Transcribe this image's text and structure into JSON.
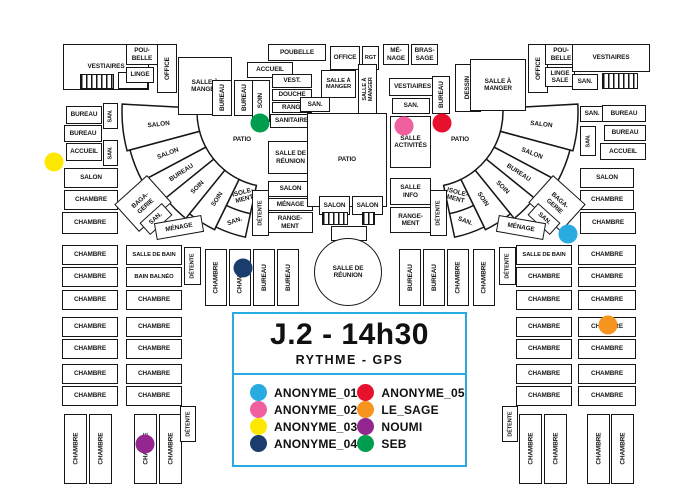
{
  "legend": {
    "title": "J.2 - 14h30",
    "subtitle": "RYTHME - GPS",
    "border_color": "#29ABE2",
    "entries": [
      {
        "name": "ANONYME_01",
        "color": "#29ABE2"
      },
      {
        "name": "ANONYME_02",
        "color": "#F0609F"
      },
      {
        "name": "ANONYME_03",
        "color": "#FFE800"
      },
      {
        "name": "ANONYME_04",
        "color": "#1B3D6D"
      },
      {
        "name": "ANONYME_05",
        "color": "#E8112D"
      },
      {
        "name": "LE_SAGE",
        "color": "#F7941D"
      },
      {
        "name": "NOUMI",
        "color": "#93278F"
      },
      {
        "name": "SEB",
        "color": "#009D4E"
      }
    ]
  },
  "floorplan": {
    "wall_color": "#161616",
    "positions": [
      {
        "name": "ANONYME_01",
        "x": 568,
        "y": 234
      },
      {
        "name": "ANONYME_02",
        "x": 404,
        "y": 126
      },
      {
        "name": "ANONYME_03",
        "x": 54,
        "y": 162
      },
      {
        "name": "ANONYME_04",
        "x": 243,
        "y": 268
      },
      {
        "name": "ANONYME_05",
        "x": 442,
        "y": 123
      },
      {
        "name": "LE_SAGE",
        "x": 608,
        "y": 325
      },
      {
        "name": "NOUMI",
        "x": 145,
        "y": 444
      },
      {
        "name": "SEB",
        "x": 260,
        "y": 123
      }
    ],
    "rooms": [
      {
        "l": "VESTIAIRES",
        "x": 63,
        "y": 44,
        "w": 86,
        "h": 46
      },
      {
        "l": "SAN.",
        "x": 118,
        "y": 72,
        "w": 30,
        "h": 17
      },
      {
        "l": "POU-\nBELLE",
        "x": 126,
        "y": 44,
        "w": 32,
        "h": 21
      },
      {
        "l": "LINGE",
        "x": 126,
        "y": 67,
        "w": 28,
        "h": 16
      },
      {
        "l": "OFFICE",
        "x": 157,
        "y": 44,
        "w": 20,
        "h": 49,
        "v": 1
      },
      {
        "l": "SALLE À\nMANGER",
        "x": 178,
        "y": 57,
        "w": 54,
        "h": 58
      },
      {
        "l": "BUREAU",
        "x": 212,
        "y": 80,
        "w": 20,
        "h": 36,
        "v": 1
      },
      {
        "l": "BUREAU",
        "x": 234,
        "y": 80,
        "w": 20,
        "h": 36,
        "v": 1
      },
      {
        "l": "BUREAU",
        "x": 66,
        "y": 106,
        "w": 36,
        "h": 18
      },
      {
        "l": "SAN.",
        "x": 103,
        "y": 103,
        "w": 15,
        "h": 26,
        "v": 1,
        "fs": 5.5
      },
      {
        "l": "BUREAU",
        "x": 64,
        "y": 125,
        "w": 38,
        "h": 17
      },
      {
        "l": "ACCUEIL",
        "x": 66,
        "y": 143,
        "w": 36,
        "h": 18
      },
      {
        "l": "SAN.",
        "x": 103,
        "y": 140,
        "w": 15,
        "h": 26,
        "v": 1,
        "fs": 5.5
      },
      {
        "l": "SALON",
        "x": 64,
        "y": 168,
        "w": 54,
        "h": 20
      },
      {
        "l": "CHAMBRE",
        "x": 64,
        "y": 190,
        "w": 54,
        "h": 20
      },
      {
        "l": "CHAMBRE",
        "x": 62,
        "y": 212,
        "w": 56,
        "h": 22
      },
      {
        "l": "ACCUEIL",
        "x": 247,
        "y": 62,
        "w": 46,
        "h": 16
      },
      {
        "l": "SOIN",
        "x": 252,
        "y": 80,
        "w": 18,
        "h": 42,
        "v": 1
      },
      {
        "l": "VEST.",
        "x": 272,
        "y": 74,
        "w": 40,
        "h": 14
      },
      {
        "l": "DOUCHE",
        "x": 272,
        "y": 89,
        "w": 40,
        "h": 12
      },
      {
        "l": "RANG.",
        "x": 272,
        "y": 102,
        "w": 40,
        "h": 11
      },
      {
        "l": "SANITAIRE",
        "x": 270,
        "y": 114,
        "w": 43,
        "h": 14
      },
      {
        "l": "SALLE DE\nRÉUNION",
        "x": 268,
        "y": 141,
        "w": 45,
        "h": 33
      },
      {
        "l": "SALON",
        "x": 268,
        "y": 181,
        "w": 45,
        "h": 16
      },
      {
        "l": "MÉNAGE",
        "x": 268,
        "y": 198,
        "w": 45,
        "h": 13
      },
      {
        "l": "RANGE-\nMENT",
        "x": 267,
        "y": 212,
        "w": 46,
        "h": 21
      },
      {
        "l": "POUBELLE",
        "x": 268,
        "y": 44,
        "w": 58,
        "h": 17
      },
      {
        "l": "OFFICE",
        "x": 330,
        "y": 46,
        "w": 30,
        "h": 24
      },
      {
        "l": "RGT",
        "x": 362,
        "y": 46,
        "w": 17,
        "h": 24,
        "fs": 5.5
      },
      {
        "l": "MÉ-\nNAGE",
        "x": 383,
        "y": 44,
        "w": 26,
        "h": 21
      },
      {
        "l": "BRAS-\nSAGE",
        "x": 411,
        "y": 44,
        "w": 27,
        "h": 21
      },
      {
        "l": "SALLE À\nMANGER",
        "x": 321,
        "y": 70,
        "w": 35,
        "h": 28,
        "fs": 5.8
      },
      {
        "l": "SALLE À\nMANGER",
        "x": 358,
        "y": 64,
        "w": 19,
        "h": 50,
        "v": 1,
        "fs": 5.5
      },
      {
        "l": "SAN.",
        "x": 300,
        "y": 97,
        "w": 30,
        "h": 15
      },
      {
        "l": "PATIO",
        "x": 307,
        "y": 113,
        "w": 80,
        "h": 94
      },
      {
        "l": "SALON",
        "x": 319,
        "y": 196,
        "w": 31,
        "h": 19
      },
      {
        "l": "SALON",
        "x": 352,
        "y": 196,
        "w": 31,
        "h": 19
      },
      {
        "l": "",
        "x": 331,
        "y": 226,
        "w": 36,
        "h": 15
      },
      {
        "l": "VESTIAIRES",
        "x": 389,
        "y": 78,
        "w": 47,
        "h": 18
      },
      {
        "l": "SAN.",
        "x": 392,
        "y": 98,
        "w": 38,
        "h": 16
      },
      {
        "l": "SALLE\nACTIVITÉS",
        "x": 390,
        "y": 116,
        "w": 41,
        "h": 52
      },
      {
        "l": "SALLE\nINFO",
        "x": 390,
        "y": 178,
        "w": 41,
        "h": 27
      },
      {
        "l": "RANGE-\nMENT",
        "x": 390,
        "y": 207,
        "w": 41,
        "h": 26
      },
      {
        "l": "BUREAU",
        "x": 432,
        "y": 76,
        "w": 18,
        "h": 38,
        "v": 1
      },
      {
        "l": "DESSIN",
        "x": 455,
        "y": 64,
        "w": 26,
        "h": 48,
        "v": 1
      },
      {
        "l": "PATIO",
        "x": 222,
        "y": 132,
        "w": 40,
        "h": 16,
        "nb": 1
      },
      {
        "l": "PATIO",
        "x": 440,
        "y": 132,
        "w": 40,
        "h": 16,
        "nb": 1
      },
      {
        "l": "SALLE À\nMANGER",
        "x": 470,
        "y": 59,
        "w": 56,
        "h": 52
      },
      {
        "l": "OFFICE",
        "x": 528,
        "y": 44,
        "w": 20,
        "h": 49,
        "v": 1
      },
      {
        "l": "POU-\nBELLE",
        "x": 545,
        "y": 44,
        "w": 32,
        "h": 21
      },
      {
        "l": "LINGE\nSALE",
        "x": 545,
        "y": 67,
        "w": 30,
        "h": 20
      },
      {
        "l": "VESTIAIRES",
        "x": 572,
        "y": 44,
        "w": 78,
        "h": 28
      },
      {
        "l": "SAN.",
        "x": 572,
        "y": 74,
        "w": 26,
        "h": 16
      },
      {
        "l": "SAN.",
        "x": 580,
        "y": 106,
        "w": 24,
        "h": 16
      },
      {
        "l": "BUREAU",
        "x": 602,
        "y": 105,
        "w": 44,
        "h": 17
      },
      {
        "l": "SAN.",
        "x": 580,
        "y": 126,
        "w": 16,
        "h": 30,
        "v": 1,
        "fs": 5.5
      },
      {
        "l": "BUREAU",
        "x": 604,
        "y": 125,
        "w": 42,
        "h": 16
      },
      {
        "l": "ACCUEIL",
        "x": 600,
        "y": 143,
        "w": 46,
        "h": 17
      },
      {
        "l": "SALON",
        "x": 580,
        "y": 168,
        "w": 54,
        "h": 20
      },
      {
        "l": "CHAMBRE",
        "x": 580,
        "y": 190,
        "w": 54,
        "h": 20
      },
      {
        "l": "CHAMBRE",
        "x": 580,
        "y": 212,
        "w": 56,
        "h": 22
      },
      {
        "l": "BAGA-\nGERIE",
        "x": 121,
        "y": 185,
        "w": 44,
        "h": 37,
        "rot": -42
      },
      {
        "l": "SAN.",
        "x": 141,
        "y": 211,
        "w": 30,
        "h": 16,
        "rot": -42
      },
      {
        "l": "MÉNAGE",
        "x": 155,
        "y": 219,
        "w": 48,
        "h": 17,
        "rot": -10
      },
      {
        "l": "BAGA-\nGERIE",
        "x": 535,
        "y": 185,
        "w": 44,
        "h": 37,
        "rot": 42
      },
      {
        "l": "SAN.",
        "x": 529,
        "y": 211,
        "w": 30,
        "h": 16,
        "rot": 42
      },
      {
        "l": "MÉNAGE",
        "x": 497,
        "y": 219,
        "w": 48,
        "h": 17,
        "rot": 10
      },
      {
        "l": "DÉTENTE",
        "x": 252,
        "y": 190,
        "w": 17,
        "h": 46,
        "v": 1,
        "fs": 5.5
      },
      {
        "l": "DÉTENTE",
        "x": 430,
        "y": 190,
        "w": 17,
        "h": 46,
        "v": 1,
        "fs": 5.5
      },
      {
        "l": "DÉTENTE",
        "x": 184,
        "y": 247,
        "w": 17,
        "h": 38,
        "v": 1,
        "fs": 5.5
      },
      {
        "l": "CHAMBRE",
        "x": 205,
        "y": 249,
        "w": 22,
        "h": 57,
        "v": 1
      },
      {
        "l": "CHAMBRE",
        "x": 229,
        "y": 249,
        "w": 22,
        "h": 57,
        "v": 1
      },
      {
        "l": "BUREAU",
        "x": 253,
        "y": 249,
        "w": 22,
        "h": 57,
        "v": 1
      },
      {
        "l": "BUREAU",
        "x": 277,
        "y": 249,
        "w": 22,
        "h": 57,
        "v": 1
      },
      {
        "l": "BUREAU",
        "x": 399,
        "y": 249,
        "w": 22,
        "h": 57,
        "v": 1
      },
      {
        "l": "BUREAU",
        "x": 423,
        "y": 249,
        "w": 22,
        "h": 57,
        "v": 1
      },
      {
        "l": "CHAMBRE",
        "x": 447,
        "y": 249,
        "w": 22,
        "h": 57,
        "v": 1
      },
      {
        "l": "CHAMBRE",
        "x": 473,
        "y": 249,
        "w": 22,
        "h": 57,
        "v": 1
      },
      {
        "l": "DÉTENTE",
        "x": 499,
        "y": 247,
        "w": 17,
        "h": 38,
        "v": 1,
        "fs": 5.5
      },
      {
        "l": "CHAMBRE",
        "x": 62,
        "y": 245,
        "w": 56,
        "h": 20
      },
      {
        "l": "CHAMBRE",
        "x": 62,
        "y": 267,
        "w": 56,
        "h": 20
      },
      {
        "l": "CHAMBRE",
        "x": 62,
        "y": 290,
        "w": 56,
        "h": 20
      },
      {
        "l": "CHAMBRE",
        "x": 62,
        "y": 317,
        "w": 56,
        "h": 20
      },
      {
        "l": "CHAMBRE",
        "x": 62,
        "y": 339,
        "w": 56,
        "h": 20
      },
      {
        "l": "CHAMBRE",
        "x": 62,
        "y": 364,
        "w": 56,
        "h": 20
      },
      {
        "l": "CHAMBRE",
        "x": 62,
        "y": 386,
        "w": 56,
        "h": 20
      },
      {
        "l": "SALLE DE BAIN",
        "x": 126,
        "y": 245,
        "w": 56,
        "h": 20,
        "fs": 5.8
      },
      {
        "l": "BAIN BALNÉO",
        "x": 126,
        "y": 267,
        "w": 56,
        "h": 20,
        "fs": 5.8
      },
      {
        "l": "CHAMBRE",
        "x": 126,
        "y": 290,
        "w": 56,
        "h": 20
      },
      {
        "l": "CHAMBRE",
        "x": 126,
        "y": 317,
        "w": 56,
        "h": 20
      },
      {
        "l": "CHAMBRE",
        "x": 126,
        "y": 339,
        "w": 56,
        "h": 20
      },
      {
        "l": "CHAMBRE",
        "x": 126,
        "y": 364,
        "w": 56,
        "h": 20
      },
      {
        "l": "CHAMBRE",
        "x": 126,
        "y": 386,
        "w": 56,
        "h": 20
      },
      {
        "l": "SALLE DE BAIN",
        "x": 516,
        "y": 245,
        "w": 56,
        "h": 20,
        "fs": 5.8
      },
      {
        "l": "CHAMBRE",
        "x": 516,
        "y": 267,
        "w": 56,
        "h": 20
      },
      {
        "l": "CHAMBRE",
        "x": 516,
        "y": 290,
        "w": 56,
        "h": 20
      },
      {
        "l": "CHAMBRE",
        "x": 516,
        "y": 317,
        "w": 56,
        "h": 20
      },
      {
        "l": "CHAMBRE",
        "x": 516,
        "y": 339,
        "w": 56,
        "h": 20
      },
      {
        "l": "CHAMBRE",
        "x": 516,
        "y": 364,
        "w": 56,
        "h": 20
      },
      {
        "l": "CHAMBRE",
        "x": 516,
        "y": 386,
        "w": 56,
        "h": 20
      },
      {
        "l": "CHAMBRE",
        "x": 578,
        "y": 245,
        "w": 58,
        "h": 20
      },
      {
        "l": "CHAMBRE",
        "x": 578,
        "y": 267,
        "w": 58,
        "h": 20
      },
      {
        "l": "CHAMBRE",
        "x": 578,
        "y": 290,
        "w": 58,
        "h": 20
      },
      {
        "l": "CHAMBRE",
        "x": 578,
        "y": 317,
        "w": 58,
        "h": 20
      },
      {
        "l": "CHAMBRE",
        "x": 578,
        "y": 339,
        "w": 58,
        "h": 20
      },
      {
        "l": "CHAMBRE",
        "x": 578,
        "y": 364,
        "w": 58,
        "h": 20
      },
      {
        "l": "CHAMBRE",
        "x": 578,
        "y": 386,
        "w": 58,
        "h": 20
      },
      {
        "l": "CHAMBRE",
        "x": 64,
        "y": 414,
        "w": 23,
        "h": 70,
        "v": 1
      },
      {
        "l": "CHAMBRE",
        "x": 89,
        "y": 414,
        "w": 23,
        "h": 70,
        "v": 1
      },
      {
        "l": "CHAMBRE",
        "x": 134,
        "y": 414,
        "w": 23,
        "h": 70,
        "v": 1
      },
      {
        "l": "CHAMBRE",
        "x": 159,
        "y": 414,
        "w": 23,
        "h": 70,
        "v": 1
      },
      {
        "l": "DÉTENTE",
        "x": 180,
        "y": 406,
        "w": 16,
        "h": 36,
        "v": 1,
        "fs": 5.5
      },
      {
        "l": "DÉTENTE",
        "x": 502,
        "y": 406,
        "w": 16,
        "h": 36,
        "v": 1,
        "fs": 5.5
      },
      {
        "l": "CHAMBRE",
        "x": 519,
        "y": 414,
        "w": 23,
        "h": 70,
        "v": 1
      },
      {
        "l": "CHAMBRE",
        "x": 544,
        "y": 414,
        "w": 23,
        "h": 70,
        "v": 1
      },
      {
        "l": "CHAMBRE",
        "x": 587,
        "y": 414,
        "w": 23,
        "h": 70,
        "v": 1
      },
      {
        "l": "CHAMBRE",
        "x": 611,
        "y": 414,
        "w": 23,
        "h": 70,
        "v": 1
      }
    ],
    "stairs": [
      {
        "x": 80,
        "y": 74,
        "w": 34,
        "h": 15
      },
      {
        "x": 602,
        "y": 73,
        "w": 36,
        "h": 16
      },
      {
        "x": 322,
        "y": 212,
        "w": 26,
        "h": 13
      },
      {
        "x": 362,
        "y": 212,
        "w": 13,
        "h": 13
      }
    ],
    "circles": [
      {
        "l": "SALLE DE\nRÉUNION",
        "cx": 348,
        "cy": 272,
        "r": 34
      }
    ],
    "fans": [
      {
        "cx": 272,
        "cy": 112,
        "rooms": [
          {
            "l": "SALON",
            "a0": 183,
            "a1": 165,
            "r0": 75,
            "r1": 150,
            "lr": 114,
            "rot": -6
          },
          {
            "l": "SALON",
            "a0": 165,
            "a1": 152,
            "r0": 75,
            "r1": 147,
            "lr": 112,
            "rot": -21
          },
          {
            "l": "BUREAU",
            "a0": 152,
            "a1": 141,
            "r0": 75,
            "r1": 142,
            "lr": 109,
            "rot": -33
          },
          {
            "l": "SOIN",
            "a0": 141,
            "a1": 129,
            "r0": 75,
            "r1": 137,
            "lr": 106,
            "rot": -45
          },
          {
            "l": "SOIN",
            "a0": 129,
            "a1": 116,
            "r0": 75,
            "r1": 131,
            "lr": 103,
            "rot": -57
          },
          {
            "l": "ISOLE-\nMENT",
            "a0": 116,
            "a1": 102,
            "r0": 75,
            "r1": 104,
            "lr": 88,
            "rot": -15
          },
          {
            "l": "SAN.",
            "a0": 116,
            "a1": 102,
            "r0": 104,
            "r1": 128,
            "lr": 115,
            "rot": -20
          }
        ]
      },
      {
        "cx": 428,
        "cy": 112,
        "rooms": [
          {
            "l": "SALON",
            "a0": -3,
            "a1": 15,
            "r0": 75,
            "r1": 150,
            "lr": 114,
            "rot": 6
          },
          {
            "l": "SALON",
            "a0": 15,
            "a1": 28,
            "r0": 75,
            "r1": 147,
            "lr": 112,
            "rot": 21
          },
          {
            "l": "BUREAU",
            "a0": 28,
            "a1": 39,
            "r0": 75,
            "r1": 142,
            "lr": 109,
            "rot": 33
          },
          {
            "l": "SOIN",
            "a0": 39,
            "a1": 51,
            "r0": 75,
            "r1": 137,
            "lr": 106,
            "rot": 45
          },
          {
            "l": "SOIN",
            "a0": 51,
            "a1": 64,
            "r0": 75,
            "r1": 131,
            "lr": 103,
            "rot": 57
          },
          {
            "l": "ISOLE-\nMENT",
            "a0": 64,
            "a1": 78,
            "r0": 75,
            "r1": 104,
            "lr": 88,
            "rot": 15
          },
          {
            "l": "SAN.",
            "a0": 64,
            "a1": 78,
            "r0": 104,
            "r1": 128,
            "lr": 115,
            "rot": 20
          }
        ]
      }
    ]
  }
}
